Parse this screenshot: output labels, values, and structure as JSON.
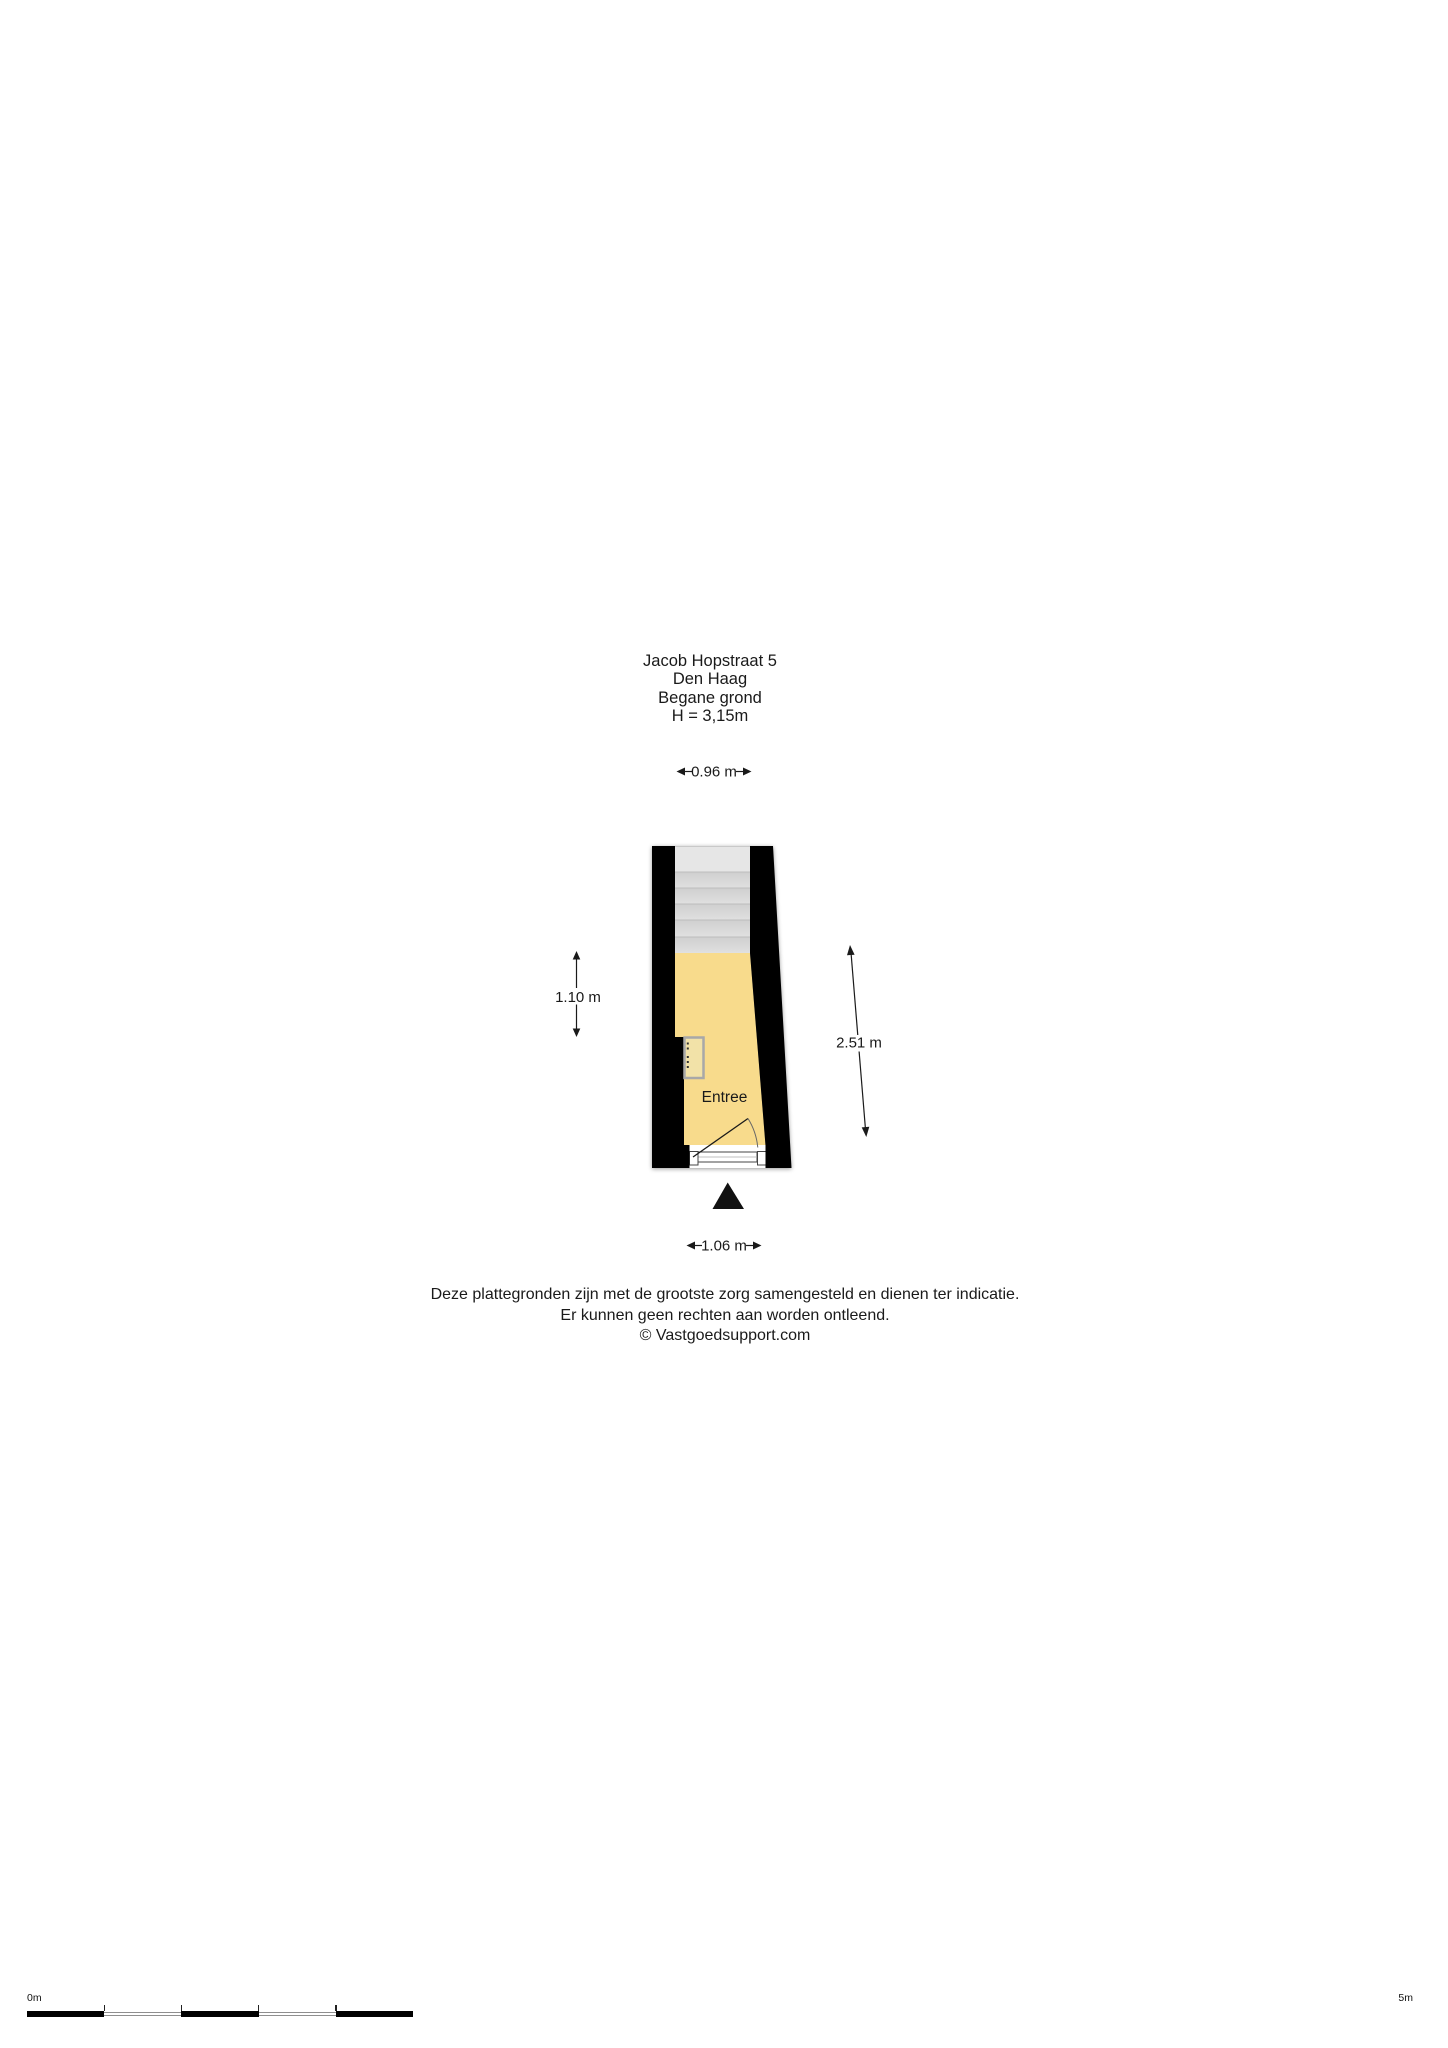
{
  "title_block": {
    "lines": [
      "Jacob Hopstraat 5",
      "Den Haag",
      "Begane grond",
      "H = 3,15m"
    ]
  },
  "floor_plan": {
    "room_label": "Entree",
    "dimensions": {
      "width_top": "0.96 m",
      "height_left": "1.10 m",
      "height_right": "2.51 m",
      "width_bottom": "1.06 m"
    },
    "colors": {
      "wall": "#000000",
      "room_fill": "#F8DB8C",
      "stair_fill": "#DADADA",
      "stair_landing": "#E6E6E6",
      "fixture_frame": "#A8A8A8",
      "entrance_marker": "#111111"
    }
  },
  "disclaimer": {
    "lines": [
      "Deze plattegronden zijn met de grootste zorg samengesteld en dienen ter indicatie.",
      "Er kunnen geen rechten aan worden ontleend.",
      "© Vastgoedsupport.com"
    ]
  },
  "scale_bar": {
    "start_label": "0m",
    "end_label": "5m",
    "segments": 5
  }
}
